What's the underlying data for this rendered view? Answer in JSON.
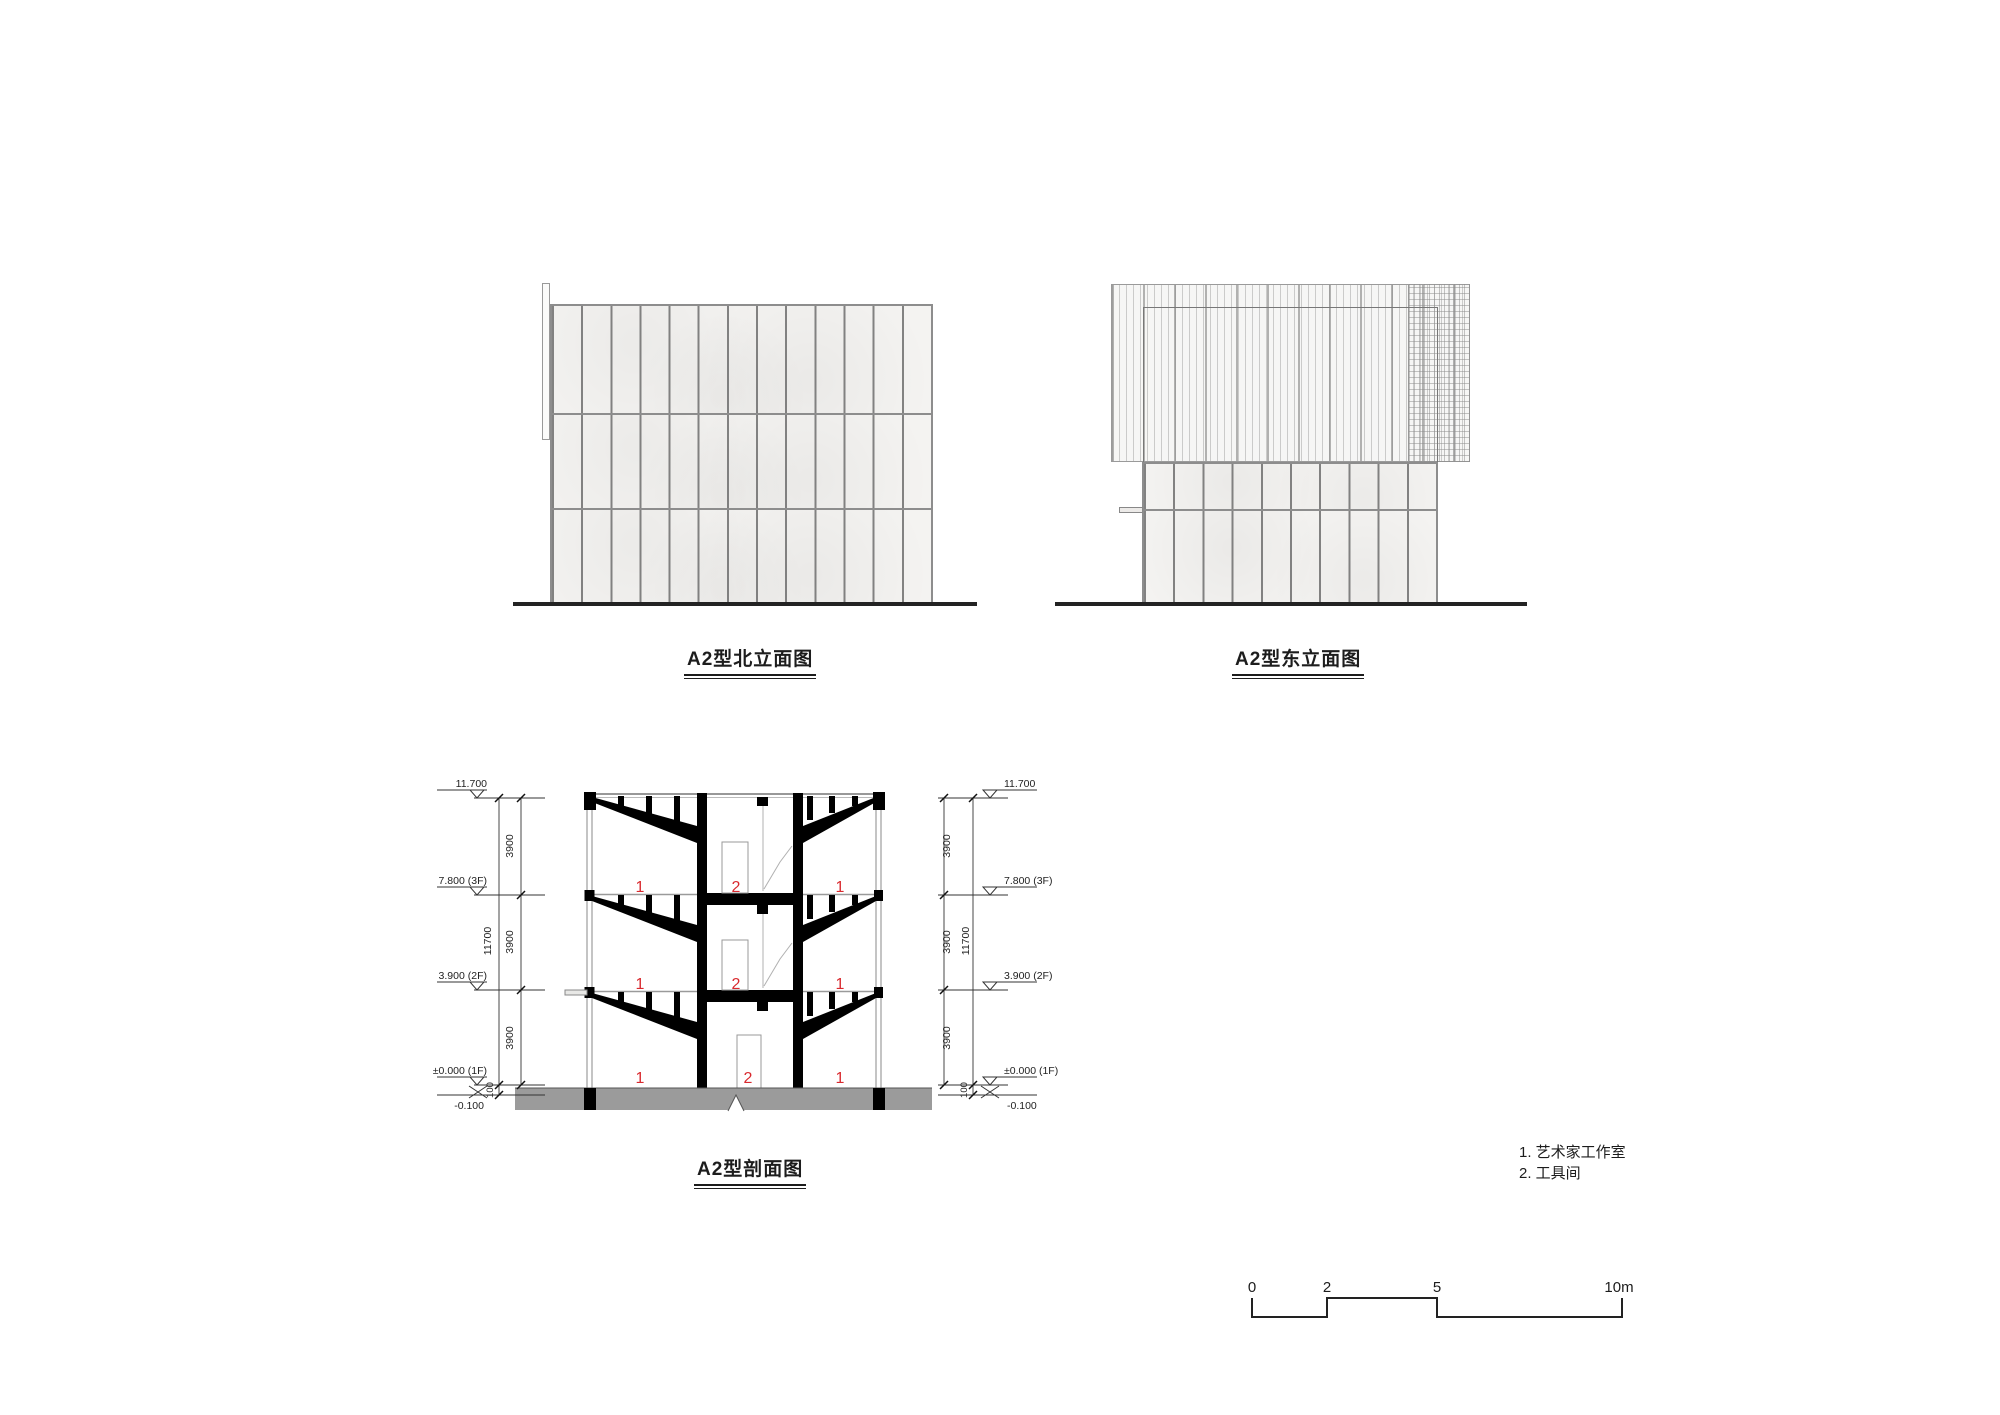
{
  "titles": {
    "north": "A2型北立面图",
    "east": "A2型东立面图",
    "section": "A2型剖面图"
  },
  "dimensions": {
    "level_roof": "11.700",
    "level_3f": "7.800 (3F)",
    "level_2f": "3.900 (2F)",
    "level_1f": "±0.000 (1F)",
    "level_below": "-0.100",
    "storey_height": "3900",
    "total_height": "11700",
    "foundation_offset": "100"
  },
  "room_labels": {
    "studio": "1",
    "tool": "2"
  },
  "legend": {
    "items": [
      "1. 艺术家工作室",
      "2. 工具间"
    ]
  },
  "scale_bar": {
    "ticks": [
      "0",
      "2",
      "5",
      "10m"
    ]
  },
  "colors": {
    "label_red": "#d9292e",
    "poche_black": "#000000",
    "foundation_gray": "#9b9b9b",
    "line_dark": "#222222"
  }
}
